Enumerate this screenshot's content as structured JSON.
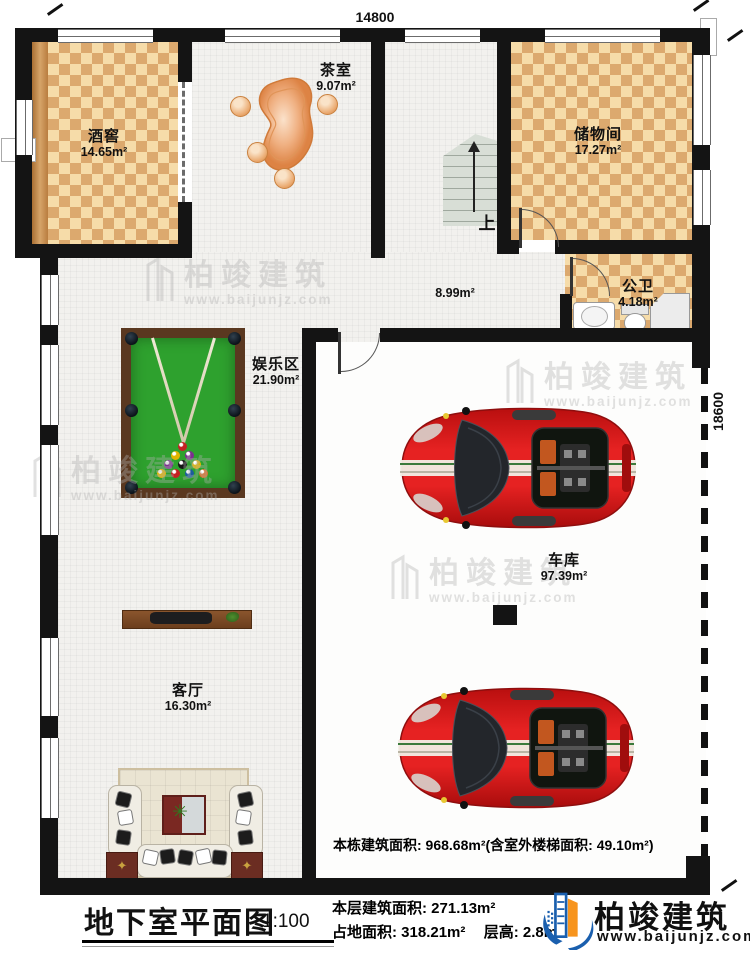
{
  "title": {
    "text": "地下室平面图",
    "scale": "1:100"
  },
  "dims": {
    "width": "14800",
    "height": "18600"
  },
  "rooms": {
    "wine": {
      "name": "酒窖",
      "area": "14.65m²"
    },
    "tea": {
      "name": "茶室",
      "area": "9.07m²"
    },
    "storage": {
      "name": "储物间",
      "area": "17.27m²"
    },
    "bath": {
      "name": "公卫",
      "area": "4.18m²"
    },
    "hall": {
      "area": "8.99m²"
    },
    "entertainment": {
      "name": "娱乐区",
      "area": "21.90m²"
    },
    "garage": {
      "name": "车库",
      "area": "97.39m²"
    },
    "living": {
      "name": "客厅",
      "area": "16.30m²"
    }
  },
  "stairs": {
    "up": "上"
  },
  "notes": {
    "building": "本栋建筑面积: 968.68m²(含室外楼梯面积: 49.10m²)",
    "floor": "本层建筑面积: 271.13m²",
    "footprint": "占地面积: 318.21m²",
    "height": "层高: 2.8m"
  },
  "brand": {
    "name": "柏竣建筑",
    "url": "www.baijunjz.com"
  },
  "watermark": {
    "name": "柏竣建筑",
    "url": "www.baijunjz.com"
  },
  "colors": {
    "accent_blue": "#1a5fae",
    "accent_orange": "#f7941d",
    "checker_light": "#f6dca9",
    "checker_dark": "#dca96e",
    "table_green": "#2ea12e",
    "car_red": "#c8121a"
  }
}
